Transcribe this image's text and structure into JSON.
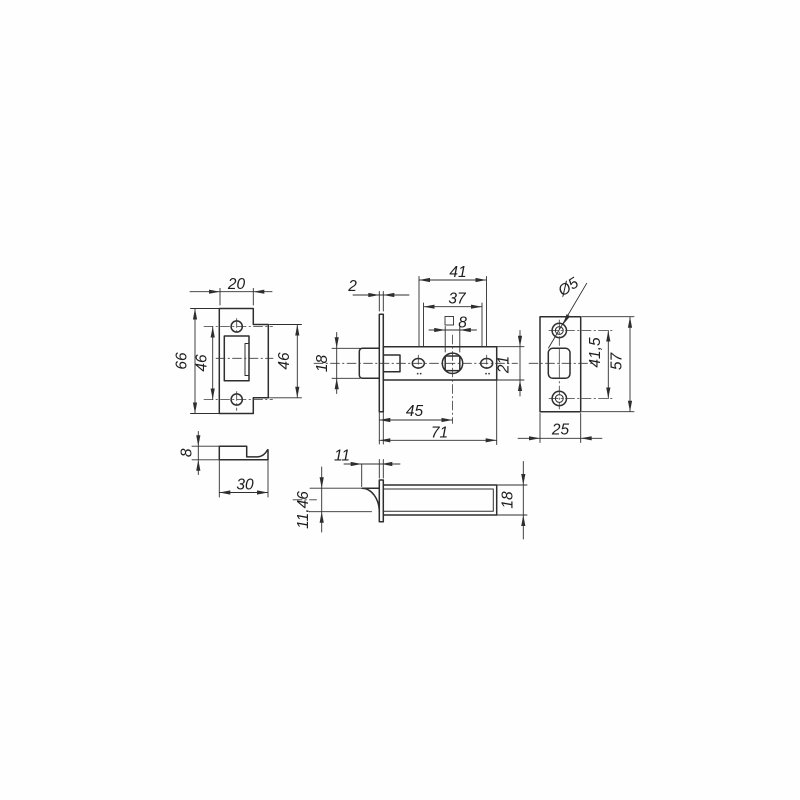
{
  "drawing": {
    "line_color": "#2e2e2e",
    "background": "#fefefe",
    "views": {
      "strike_plate_front": {
        "width": "20",
        "overall_height": "66",
        "hole_spacing": "46",
        "tab_height": "46"
      },
      "latch_body_side": {
        "faceplate_thickness": "2",
        "hole_spacing_outer": "41",
        "hole_spacing_inner": "37",
        "spindle_square": "8",
        "bolt_height": "18",
        "case_height": "21",
        "backset": "45",
        "overall_length": "71"
      },
      "faceplate_front": {
        "screw_hole_diameter": "Ø5",
        "screw_hole_spacing": "41,5",
        "height": "57",
        "width": "25"
      },
      "strike_plate_side": {
        "offset": "8",
        "depth": "30"
      },
      "latch_top": {
        "bolt_projection": "11",
        "bolt_width": "11,46",
        "case_width": "18"
      }
    }
  }
}
